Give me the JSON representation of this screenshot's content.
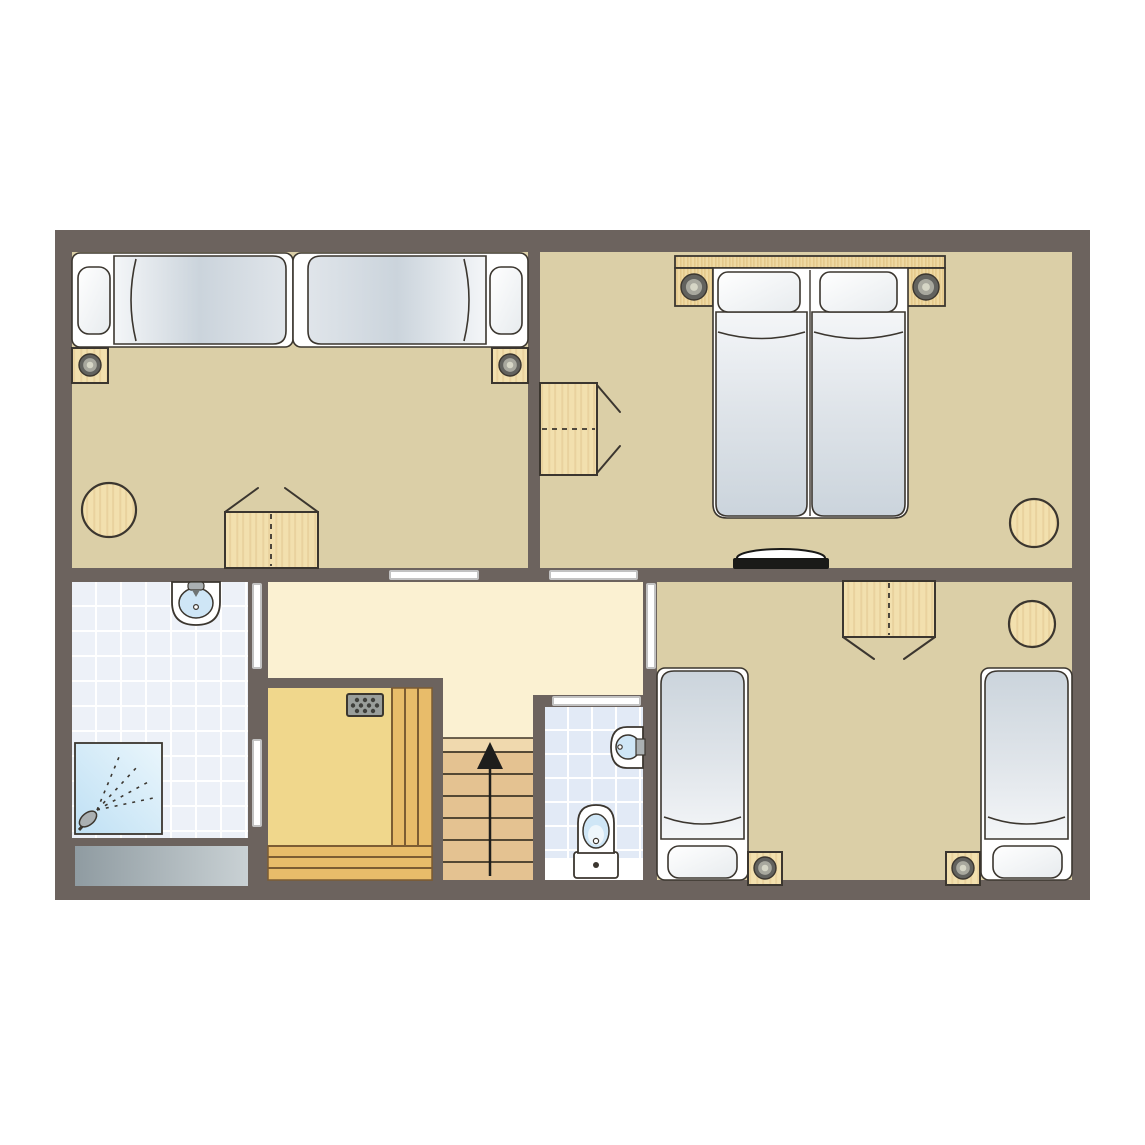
{
  "canvas": {
    "width": 1145,
    "height": 1145,
    "background": "#FFFFFF"
  },
  "colors": {
    "wall": "#6C635E",
    "floor_bedroom": "#DBCFA7",
    "floor_hall": "#FBF1D2",
    "floor_sauna": "#F0D78C",
    "bench": "#E8BC6A",
    "bench_line": "#7C5C33",
    "stair": "#E4C291",
    "stair_light": "#F0D9AE",
    "stair_line": "#3F3627",
    "tile_bath": "#EDF1F8",
    "tile_wc": "#E2EAF6",
    "tile_line": "#FFFFFF",
    "outline": "#3B362F",
    "bed_white": "#FFFFFF",
    "duvet_dark": "#CBD4DC",
    "duvet_mid": "#E0E5EA",
    "duvet_light": "#F4F6F8",
    "pillow_dark": "#E7EBEE",
    "wood": "#F2E0AE",
    "wood_grain": "#DFC48D",
    "headboard": "#EFD9A2",
    "headboard_grain": "#DCBD7C",
    "lamp_outer": "#62625E",
    "lamp_mid": "#A8A89E",
    "lamp_center": "#D6D6C6",
    "stove": "#9A9E9B",
    "stove_dot": "#3F3F3B",
    "door_leaf_stroke": "#C2C2C2",
    "window_dark": "#8F9BA1",
    "window_light": "#C9D1D4",
    "shower_dark": "#BFE0F4",
    "shower_light": "#EAF6FC",
    "basin_blue": "#CFE6F6",
    "basin_blue_light": "#EEF6FB",
    "metal": "#AAB0B2",
    "spout": "#6F7473",
    "black": "#1A1A18",
    "arrow": "#1E1E1C",
    "white": "#FFFFFF"
  },
  "plan": {
    "outer_wall": {
      "x": 55,
      "y": 230,
      "w": 1035,
      "h": 670
    },
    "floors": [
      {
        "name": "floor-bedroom-1",
        "rect": [
          72,
          252,
          456,
          316
        ],
        "fill": "floor_bedroom"
      },
      {
        "name": "floor-bedroom-2",
        "rect": [
          540,
          252,
          532,
          316
        ],
        "fill": "floor_bedroom"
      },
      {
        "name": "floor-bathroom",
        "rect": [
          72,
          582,
          176,
          256
        ],
        "fill": "tile_bath"
      },
      {
        "name": "floor-hallway-a",
        "rect": [
          268,
          582,
          375,
          96
        ],
        "fill": "floor_hall"
      },
      {
        "name": "floor-hallway-b",
        "rect": [
          443,
          678,
          90,
          60
        ],
        "fill": "floor_hall"
      },
      {
        "name": "floor-hallway-c",
        "rect": [
          533,
          678,
          110,
          17
        ],
        "fill": "floor_hall"
      },
      {
        "name": "floor-sauna",
        "rect": [
          268,
          688,
          164,
          192
        ],
        "fill": "floor_sauna"
      },
      {
        "name": "floor-wc",
        "rect": [
          545,
          707,
          98,
          173
        ],
        "fill": "tile_wc"
      },
      {
        "name": "floor-bedroom-3",
        "rect": [
          657,
          582,
          415,
          298
        ],
        "fill": "floor_bedroom"
      }
    ],
    "windows": [
      {
        "name": "bathroom-window",
        "rect": [
          75,
          846,
          173,
          40
        ]
      }
    ],
    "doors": [
      {
        "name": "door-bedroom-1",
        "rect": [
          390,
          571,
          88,
          8
        ]
      },
      {
        "name": "door-bedroom-2",
        "rect": [
          550,
          571,
          87,
          8
        ]
      },
      {
        "name": "door-bathroom",
        "rect": [
          253,
          584,
          8,
          84
        ]
      },
      {
        "name": "door-sauna",
        "rect": [
          253,
          740,
          8,
          86
        ]
      },
      {
        "name": "door-bedroom-3",
        "rect": [
          647,
          584,
          8,
          84
        ]
      },
      {
        "name": "door-wc",
        "rect": [
          553,
          697,
          87,
          8
        ]
      }
    ],
    "furniture": [
      {
        "type": "bed-single",
        "name": "bed-1-left",
        "frame": [
          72,
          253,
          221,
          94
        ],
        "pillow": [
          78,
          267,
          32,
          67
        ],
        "duvet": [
          114,
          256,
          172,
          88
        ],
        "grad": "left",
        "arc": {
          "axis": "v",
          "at": 136,
          "from": 259,
          "to": 341,
          "bow": -10
        }
      },
      {
        "type": "bed-single",
        "name": "bed-1-right",
        "frame": [
          293,
          253,
          235,
          94
        ],
        "pillow": [
          490,
          267,
          32,
          67
        ],
        "duvet": [
          308,
          256,
          178,
          88
        ],
        "grad": "right",
        "arc": {
          "axis": "v",
          "at": 464,
          "from": 259,
          "to": 341,
          "bow": 10
        }
      },
      {
        "type": "nightstand",
        "name": "nightstand-1-left",
        "rect": [
          72,
          348,
          36,
          35
        ],
        "lamp": [
          90,
          365
        ]
      },
      {
        "type": "nightstand",
        "name": "nightstand-1-right",
        "rect": [
          492,
          348,
          36,
          35
        ],
        "lamp": [
          510,
          365
        ]
      },
      {
        "type": "stool",
        "name": "stool-1",
        "cx": 109,
        "cy": 510,
        "r": 27
      },
      {
        "type": "desk",
        "name": "desk-1",
        "rect": [
          225,
          512,
          93,
          56
        ],
        "dash": {
          "axis": "v",
          "at": 271,
          "from": 514,
          "to": 566
        },
        "chair": [
          [
            225,
            512,
            258,
            488
          ],
          [
            318,
            512,
            285,
            488
          ]
        ]
      },
      {
        "type": "headboard",
        "name": "headboard-2",
        "strip": [
          675,
          256,
          270,
          12
        ],
        "wings": [
          [
            675,
            268,
            38,
            38
          ],
          [
            907,
            268,
            38,
            38
          ]
        ],
        "lamps": [
          [
            694,
            287
          ],
          [
            926,
            287
          ]
        ]
      },
      {
        "type": "bed-double",
        "name": "bed-2-double",
        "frame": [
          713,
          268,
          195,
          250
        ],
        "divider": 810,
        "pillows": [
          [
            718,
            272,
            82,
            40
          ],
          [
            820,
            272,
            77,
            40
          ]
        ],
        "mattresses": [
          [
            716,
            312,
            91,
            204
          ],
          [
            812,
            312,
            93,
            204
          ]
        ],
        "arcs": [
          {
            "axis": "h",
            "at": 332,
            "from": 718,
            "to": 805,
            "bow": 13
          },
          {
            "axis": "h",
            "at": 332,
            "from": 814,
            "to": 903,
            "bow": 13
          }
        ]
      },
      {
        "type": "desk",
        "name": "desk-2",
        "rect": [
          540,
          383,
          57,
          92
        ],
        "dash": {
          "axis": "h",
          "at": 429,
          "from": 542,
          "to": 595
        },
        "chair": [
          [
            597,
            385,
            620,
            412
          ],
          [
            597,
            473,
            620,
            446
          ]
        ]
      },
      {
        "type": "stool",
        "name": "stool-2",
        "cx": 1034,
        "cy": 523,
        "r": 24
      },
      {
        "type": "tv",
        "name": "tv-2",
        "ellipse": [
          781,
          558,
          44,
          9
        ],
        "bar": [
          733,
          558,
          96,
          11
        ]
      },
      {
        "type": "desk",
        "name": "desk-3",
        "rect": [
          843,
          581,
          92,
          56
        ],
        "dash": {
          "axis": "v",
          "at": 889,
          "from": 583,
          "to": 635
        },
        "chair": [
          [
            843,
            637,
            874,
            659
          ],
          [
            935,
            637,
            904,
            659
          ]
        ]
      },
      {
        "type": "stool",
        "name": "stool-3",
        "cx": 1032,
        "cy": 624,
        "r": 23
      },
      {
        "type": "bed-single",
        "name": "bed-3-left",
        "frame": [
          657,
          668,
          91,
          212
        ],
        "pillow": [
          668,
          846,
          69,
          32
        ],
        "duvet": [
          661,
          671,
          83,
          168
        ],
        "grad": "bottom",
        "arc": {
          "axis": "h",
          "at": 817,
          "from": 664,
          "to": 741,
          "bow": 14
        }
      },
      {
        "type": "bed-single",
        "name": "bed-3-right",
        "frame": [
          981,
          668,
          91,
          212
        ],
        "pillow": [
          993,
          846,
          69,
          32
        ],
        "duvet": [
          985,
          671,
          83,
          168
        ],
        "grad": "bottom",
        "arc": {
          "axis": "h",
          "at": 817,
          "from": 988,
          "to": 1065,
          "bow": 14
        }
      },
      {
        "type": "nightstand",
        "name": "nightstand-3-left",
        "rect": [
          748,
          852,
          34,
          33
        ],
        "lamp": [
          765,
          868
        ]
      },
      {
        "type": "nightstand",
        "name": "nightstand-3-right",
        "rect": [
          946,
          852,
          34,
          33
        ],
        "lamp": [
          963,
          868
        ]
      },
      {
        "type": "washbasin-top",
        "name": "washbasin-bathroom",
        "cx": 196,
        "top": 582
      },
      {
        "type": "shower",
        "name": "shower",
        "rect": [
          75,
          743,
          87,
          91
        ]
      },
      {
        "type": "planks",
        "name": "sauna-bench-right",
        "rect": [
          392,
          688,
          40,
          192
        ],
        "lines": [
          [
            392,
            688,
            392,
            880
          ],
          [
            405,
            688,
            405,
            880
          ],
          [
            418,
            688,
            418,
            880
          ]
        ]
      },
      {
        "type": "planks",
        "name": "sauna-bench-bottom",
        "rect": [
          268,
          846,
          164,
          34
        ],
        "lines": [
          [
            268,
            846,
            432,
            846
          ],
          [
            268,
            857,
            432,
            857
          ],
          [
            268,
            868,
            432,
            868
          ]
        ]
      },
      {
        "type": "stove",
        "name": "sauna-stove",
        "rect": [
          347,
          694,
          36,
          22
        ]
      },
      {
        "type": "stairs",
        "name": "staircase",
        "rect": [
          443,
          738,
          90,
          142
        ],
        "treads": [
          752,
          774,
          796,
          818,
          840,
          862
        ],
        "arrow": {
          "x": 490,
          "y1": 876,
          "y2": 756,
          "head": [
            [
              490,
              742
            ],
            [
              477,
              769
            ],
            [
              503,
              769
            ]
          ]
        }
      },
      {
        "type": "toilet",
        "name": "toilet",
        "cx": 596,
        "band": [
          545,
          858,
          98,
          22
        ],
        "tank": [
          574,
          852,
          44,
          26
        ]
      },
      {
        "type": "washbasin-wall",
        "name": "washbasin-wc",
        "wallX": 643,
        "cy": 747
      }
    ]
  }
}
